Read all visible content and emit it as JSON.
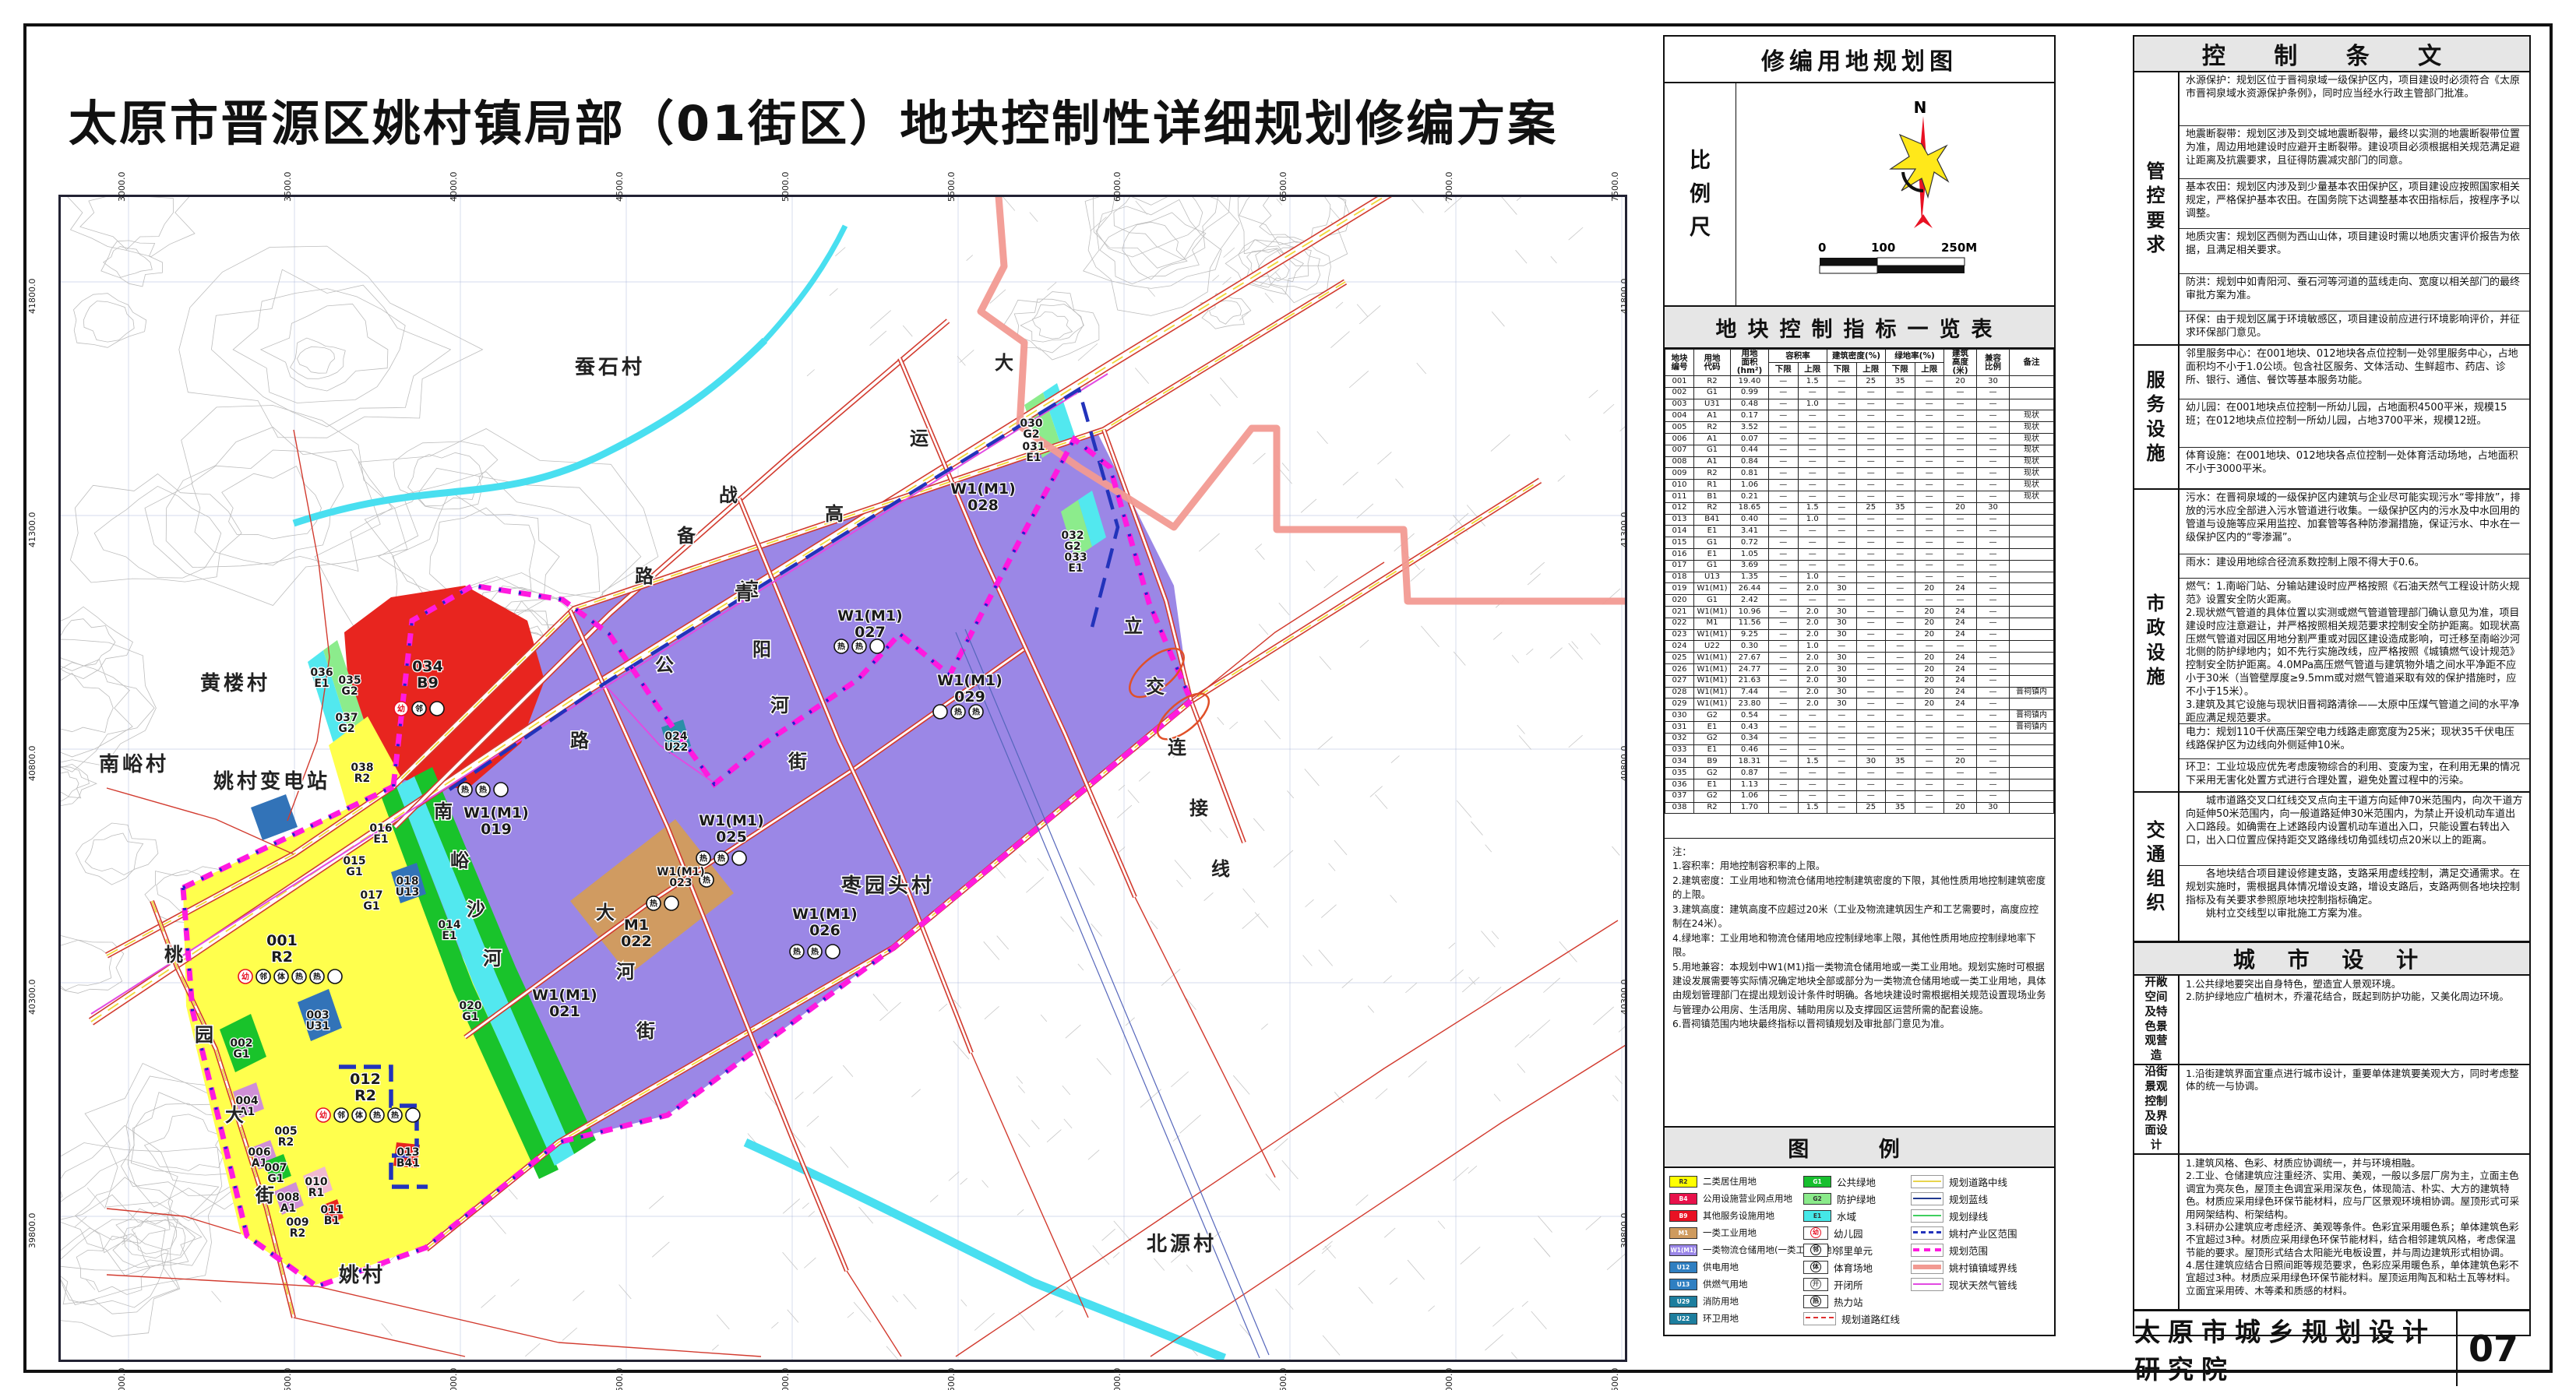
{
  "title": "太原市晋源区姚村镇局部（01街区）地块控制性详细规划修编方案",
  "footer": {
    "institute": "太原市城乡规划设计研究院",
    "page": "07"
  },
  "map": {
    "top_ticks": [
      "3000.0",
      "3500.0",
      "4000.0",
      "4500.0",
      "5000.0",
      "5500.0",
      "6000.0",
      "6500.0",
      "7000.0",
      "7500.0"
    ],
    "bottom_ticks": [
      "3000.0",
      "3500.0",
      "4000.0",
      "4500.0",
      "5000.0",
      "5500.0",
      "6000.0",
      "6500.0",
      "7000.0",
      "7500.0"
    ],
    "left_ticks": [
      "41800.0",
      "41300.0",
      "40800.0",
      "40300.0",
      "39800.0"
    ],
    "right_ticks": [
      "41800.0",
      "41300.0",
      "40800.0",
      "40300.0",
      "39800.0"
    ],
    "villages": [
      "黄楼村",
      "蚕石村",
      "南峪村",
      "姚村",
      "枣园头村",
      "北源村",
      "姚村变电站"
    ],
    "road_labels": [
      "大运高速公路",
      "战备路",
      "桃园大街",
      "大河街",
      "青阳河街",
      "立交连接线",
      "南峪沙河"
    ],
    "zones": [
      {
        "id": "001",
        "code": "R2"
      },
      {
        "id": "002",
        "code": "G1"
      },
      {
        "id": "003",
        "code": "U31"
      },
      {
        "id": "004",
        "code": "A1"
      },
      {
        "id": "005",
        "code": "R2"
      },
      {
        "id": "006",
        "code": "A1"
      },
      {
        "id": "007",
        "code": "G1"
      },
      {
        "id": "008",
        "code": "A1"
      },
      {
        "id": "009",
        "code": "R2"
      },
      {
        "id": "010",
        "code": "R1"
      },
      {
        "id": "011",
        "code": "B1"
      },
      {
        "id": "012",
        "code": "R2"
      },
      {
        "id": "013",
        "code": "B41"
      },
      {
        "id": "014",
        "code": "E1"
      },
      {
        "id": "015",
        "code": "G1"
      },
      {
        "id": "016",
        "code": "E1"
      },
      {
        "id": "017",
        "code": "G1"
      },
      {
        "id": "018",
        "code": "U13"
      },
      {
        "id": "019",
        "code": "W1(M1)"
      },
      {
        "id": "020",
        "code": "G1"
      },
      {
        "id": "021",
        "code": "W1(M1)"
      },
      {
        "id": "022",
        "code": "M1"
      },
      {
        "id": "023",
        "code": "W1(M1)"
      },
      {
        "id": "024",
        "code": "U22"
      },
      {
        "id": "025",
        "code": "W1(M1)"
      },
      {
        "id": "026",
        "code": "W1(M1)"
      },
      {
        "id": "027",
        "code": "W1(M1)"
      },
      {
        "id": "028",
        "code": "W1(M1)"
      },
      {
        "id": "029",
        "code": "W1(M1)"
      },
      {
        "id": "030",
        "code": "G2"
      },
      {
        "id": "031",
        "code": "E1"
      },
      {
        "id": "032",
        "code": "G2"
      },
      {
        "id": "033",
        "code": "E1"
      },
      {
        "id": "034",
        "code": "B9"
      },
      {
        "id": "035",
        "code": "G2"
      },
      {
        "id": "036",
        "code": "E1"
      },
      {
        "id": "037",
        "code": "G2"
      },
      {
        "id": "038",
        "code": "R2"
      }
    ]
  },
  "midpanel": {
    "map_title": "修编用地规划图",
    "scale_label": "比例尺",
    "north_label": "N",
    "scalebar_labels": [
      "0",
      "100",
      "250M"
    ],
    "table_title": "地块控制指标一览表",
    "table": {
      "headers": [
        "地块\n编号",
        "用地\n代码",
        "用地\n面积\n(hm²)",
        "容积率",
        "建筑密度(%)",
        "绿地率(%)",
        "建筑\n高度\n(米)",
        "兼容\n比例",
        "备注"
      ],
      "subheaders": [
        "下限",
        "上限"
      ],
      "rows": [
        [
          "001",
          "R2",
          "19.40",
          "—",
          "1.5",
          "—",
          "25",
          "35",
          "—",
          "20",
          "30",
          ""
        ],
        [
          "002",
          "G1",
          "0.99",
          "—",
          "—",
          "—",
          "—",
          "—",
          "—",
          "—",
          "—",
          ""
        ],
        [
          "003",
          "U31",
          "0.48",
          "—",
          "1.0",
          "—",
          "—",
          "—",
          "—",
          "—",
          "—",
          ""
        ],
        [
          "004",
          "A1",
          "0.17",
          "—",
          "—",
          "—",
          "—",
          "—",
          "—",
          "—",
          "—",
          "现状"
        ],
        [
          "005",
          "R2",
          "3.52",
          "—",
          "—",
          "—",
          "—",
          "—",
          "—",
          "—",
          "—",
          "现状"
        ],
        [
          "006",
          "A1",
          "0.07",
          "—",
          "—",
          "—",
          "—",
          "—",
          "—",
          "—",
          "—",
          "现状"
        ],
        [
          "007",
          "G1",
          "0.44",
          "—",
          "—",
          "—",
          "—",
          "—",
          "—",
          "—",
          "—",
          "现状"
        ],
        [
          "008",
          "A1",
          "0.84",
          "—",
          "—",
          "—",
          "—",
          "—",
          "—",
          "—",
          "—",
          "现状"
        ],
        [
          "009",
          "R2",
          "0.81",
          "—",
          "—",
          "—",
          "—",
          "—",
          "—",
          "—",
          "—",
          "现状"
        ],
        [
          "010",
          "R1",
          "1.06",
          "—",
          "—",
          "—",
          "—",
          "—",
          "—",
          "—",
          "—",
          "现状"
        ],
        [
          "011",
          "B1",
          "0.21",
          "—",
          "—",
          "—",
          "—",
          "—",
          "—",
          "—",
          "—",
          "现状"
        ],
        [
          "012",
          "R2",
          "18.65",
          "—",
          "1.5",
          "—",
          "25",
          "35",
          "—",
          "20",
          "30",
          ""
        ],
        [
          "013",
          "B41",
          "0.40",
          "—",
          "1.0",
          "—",
          "—",
          "—",
          "—",
          "—",
          "—",
          ""
        ],
        [
          "014",
          "E1",
          "3.41",
          "—",
          "—",
          "—",
          "—",
          "—",
          "—",
          "—",
          "—",
          ""
        ],
        [
          "015",
          "G1",
          "0.72",
          "—",
          "—",
          "—",
          "—",
          "—",
          "—",
          "—",
          "—",
          ""
        ],
        [
          "016",
          "E1",
          "1.05",
          "—",
          "—",
          "—",
          "—",
          "—",
          "—",
          "—",
          "—",
          ""
        ],
        [
          "017",
          "G1",
          "3.69",
          "—",
          "—",
          "—",
          "—",
          "—",
          "—",
          "—",
          "—",
          ""
        ],
        [
          "018",
          "U13",
          "1.35",
          "—",
          "1.0",
          "—",
          "—",
          "—",
          "—",
          "—",
          "—",
          ""
        ],
        [
          "019",
          "W1(M1)",
          "26.44",
          "—",
          "2.0",
          "30",
          "—",
          "—",
          "20",
          "24",
          "—",
          ""
        ],
        [
          "020",
          "G1",
          "2.42",
          "—",
          "—",
          "—",
          "—",
          "—",
          "—",
          "—",
          "—",
          ""
        ],
        [
          "021",
          "W1(M1)",
          "10.96",
          "—",
          "2.0",
          "30",
          "—",
          "—",
          "20",
          "24",
          "—",
          ""
        ],
        [
          "022",
          "M1",
          "11.56",
          "—",
          "2.0",
          "30",
          "—",
          "—",
          "20",
          "24",
          "—",
          ""
        ],
        [
          "023",
          "W1(M1)",
          "9.25",
          "—",
          "2.0",
          "30",
          "—",
          "—",
          "20",
          "24",
          "—",
          ""
        ],
        [
          "024",
          "U22",
          "0.30",
          "—",
          "1.0",
          "—",
          "—",
          "—",
          "—",
          "—",
          "—",
          ""
        ],
        [
          "025",
          "W1(M1)",
          "27.67",
          "—",
          "2.0",
          "30",
          "—",
          "—",
          "20",
          "24",
          "—",
          ""
        ],
        [
          "026",
          "W1(M1)",
          "24.77",
          "—",
          "2.0",
          "30",
          "—",
          "—",
          "20",
          "24",
          "—",
          ""
        ],
        [
          "027",
          "W1(M1)",
          "21.63",
          "—",
          "2.0",
          "30",
          "—",
          "—",
          "20",
          "24",
          "—",
          ""
        ],
        [
          "028",
          "W1(M1)",
          "7.44",
          "—",
          "2.0",
          "30",
          "—",
          "—",
          "20",
          "24",
          "—",
          "晋祠镇内"
        ],
        [
          "029",
          "W1(M1)",
          "23.80",
          "—",
          "2.0",
          "30",
          "—",
          "—",
          "20",
          "24",
          "—",
          ""
        ],
        [
          "030",
          "G2",
          "0.54",
          "—",
          "—",
          "—",
          "—",
          "—",
          "—",
          "—",
          "—",
          "晋祠镇内"
        ],
        [
          "031",
          "E1",
          "0.43",
          "—",
          "—",
          "—",
          "—",
          "—",
          "—",
          "—",
          "—",
          "晋祠镇内"
        ],
        [
          "032",
          "G2",
          "0.34",
          "—",
          "—",
          "—",
          "—",
          "—",
          "—",
          "—",
          "—",
          ""
        ],
        [
          "033",
          "E1",
          "0.46",
          "—",
          "—",
          "—",
          "—",
          "—",
          "—",
          "—",
          "—",
          ""
        ],
        [
          "034",
          "B9",
          "18.31",
          "—",
          "1.5",
          "—",
          "30",
          "35",
          "—",
          "20",
          "—",
          ""
        ],
        [
          "035",
          "G2",
          "0.87",
          "—",
          "—",
          "—",
          "—",
          "—",
          "—",
          "—",
          "—",
          ""
        ],
        [
          "036",
          "E1",
          "1.13",
          "—",
          "—",
          "—",
          "—",
          "—",
          "—",
          "—",
          "—",
          ""
        ],
        [
          "037",
          "G2",
          "1.06",
          "—",
          "—",
          "—",
          "—",
          "—",
          "—",
          "—",
          "—",
          ""
        ],
        [
          "038",
          "R2",
          "1.70",
          "—",
          "1.5",
          "—",
          "25",
          "35",
          "—",
          "20",
          "30",
          ""
        ]
      ],
      "notes": "注：\n1.容积率：用地控制容积率的上限。\n2.建筑密度：工业用地和物流仓储用地控制建筑密度的下限，其他性质用地控制建筑密度的上限。\n3.建筑高度：建筑高度不应超过20米（工业及物流建筑因生产和工艺需要时，高度应控制在24米）。\n4.绿地率：工业用地和物流仓储用地应控制绿地率上限，其他性质用地应控制绿地率下限。\n5.用地兼容：本规划中W1(M1)指一类物流仓储用地或一类工业用地。规划实施时可根据建设发展需要等实际情况确定地块全部或部分为一类物流仓储用地或一类工业用地，具体由规划管理部门在提出规划设计条件时明确。各地块建设时需根据相关规范设置现场业务与管理办公用房、生活用房、辅助用房以及支撑园区运营所需的配套设施。\n6.晋祠镇范围内地块最终指标以晋祠镇规划及审批部门意见为准。"
    },
    "legend_title": "图  例",
    "legend": {
      "col1": [
        {
          "code": "R2",
          "color": "#ffff00",
          "tc": "#333",
          "label": "二类居住用地"
        },
        {
          "code": "B4",
          "color": "#e8114b",
          "tc": "#fff",
          "label": "公用设施营业网点用地"
        },
        {
          "code": "B9",
          "color": "#e81123",
          "tc": "#fff",
          "label": "其他服务设施用地"
        },
        {
          "code": "M1",
          "color": "#cf9b5e",
          "tc": "#fff",
          "label": "一类工业用地"
        },
        {
          "code": "W1(M1)",
          "color": "#9a86e8",
          "tc": "#fff",
          "label": "一类物流仓储用地(一类工业用地)"
        },
        {
          "code": "U12",
          "color": "#2f7fc1",
          "tc": "#fff",
          "label": "供电用地"
        },
        {
          "code": "U13",
          "color": "#2f7fc1",
          "tc": "#fff",
          "label": "供燃气用地"
        },
        {
          "code": "U29",
          "color": "#1d7e9e",
          "tc": "#fff",
          "label": "消防用地"
        },
        {
          "code": "U22",
          "color": "#1d7e9e",
          "tc": "#fff",
          "label": "环卫用地"
        }
      ],
      "col2": [
        {
          "code": "G1",
          "color": "#17bf2e",
          "tc": "#fff",
          "label": "公共绿地"
        },
        {
          "code": "G2",
          "color": "#8aea8a",
          "tc": "#333",
          "label": "防护绿地"
        },
        {
          "code": "E1",
          "color": "#45e8e8",
          "tc": "#333",
          "label": "水域"
        },
        {
          "icon": "幼",
          "ic": "#e81123",
          "label": "幼儿园"
        },
        {
          "icon": "邻",
          "ic": "#111",
          "label": "邻里单元"
        },
        {
          "icon": "体",
          "ic": "#111",
          "label": "体育场地"
        },
        {
          "icon": "开",
          "ic": "#555",
          "label": "开闭所"
        },
        {
          "icon": "热",
          "ic": "#111",
          "label": "热力站"
        },
        {
          "line": "redline",
          "label": "规划道路红线"
        }
      ],
      "col3": [
        {
          "line": "centerline",
          "label": "规划道路中线"
        },
        {
          "line": "blueline",
          "label": "规划蓝线"
        },
        {
          "line": "greenline",
          "label": "规划绿线"
        },
        {
          "line": "industry",
          "label": "姚村产业区范围"
        },
        {
          "line": "scope",
          "label": "规划范围"
        },
        {
          "line": "townline",
          "label": "姚村镇镇域界线"
        },
        {
          "line": "gasline",
          "label": "现状天然气管线"
        }
      ]
    }
  },
  "provisions": {
    "title": "控  制  条  文",
    "sections": [
      {
        "label": "管控要求",
        "items": [
          "水源保护：规划区位于晋祠泉域一级保护区内，项目建设时必须符合《太原市晋祠泉域水资源保护条例》，同时应当经水行政主管部门批准。",
          "地震断裂带：规划区涉及到交城地震断裂带，最终以实测的地震断裂带位置为准，周边用地建设时应避开主断裂带。建设项目必须根据相关规范满足避让距离及抗震要求，且征得防震减灾部门的同意。",
          "基本农田：规划区内涉及到少量基本农田保护区，项目建设应按照国家相关规定，严格保护基本农田。在国务院下达调整基本农田指标后，按程序予以调整。",
          "地质灾害：规划区西侧为西山山体，项目建设时需以地质灾害评价报告为依据，且满足相关要求。",
          "防洪：规划中如青阳河、蚕石河等河道的蓝线走向、宽度以相关部门的最终审批方案为准。",
          "环保：由于规划区属于环境敏感区，项目建设前应进行环境影响评价，并征求环保部门意见。"
        ]
      },
      {
        "label": "服务设施",
        "items": [
          "邻里服务中心：在001地块、012地块各点位控制一处邻里服务中心，占地面积均不小于1.0公顷。包含社区服务、文体活动、生鲜超市、药店、诊所、银行、通信、餐饮等基本服务功能。",
          "幼儿园：在001地块点位控制一所幼儿园，占地面积4500平米，规模15班；在012地块点位控制一所幼儿园，占地3700平米，规模12班。",
          "体育设施：在001地块、012地块各点位控制一处体育活动场地，占地面积不小于3000平米。"
        ]
      },
      {
        "label": "市政设施",
        "items": [
          "污水：在晋祠泉域的一级保护区内建筑与企业尽可能实现污水“零排放”，排放的污水应全部进入污水管道进行收集。一级保护区内的污水及中水回用的管道与设施等应采用监控、加套管等各种防渗漏措施，保证污水、中水在一级保护区内的“零渗漏”。",
          "雨水：建设用地综合径流系数控制上限不得大于0.6。",
          "燃气：1.南峪门站、分输站建设时应严格按照《石油天然气工程设计防火规范》设置安全防火距离。\n2.现状燃气管道的具体位置以实测或燃气管道管理部门确认意见为准，项目建设时应注意避让，并严格按照相关规范要求控制安全防护距离。如现状高压燃气管道对园区用地分割严重或对园区建设造成影响，可迁移至南峪沙河北侧的防护绿地内；如不先行实施改线，应严格按照《城镇燃气设计规范》控制安全防护距离。4.0MPa高压燃气管道与建筑物外墙之间水平净距不应小于30米（当管壁厚度≥9.5mm或对燃气管道采取有效的保护措施时，应不小于15米）。\n3.建筑及其它设施与现状旧晋祠路清徐——太原中压煤气管道之间的水平净距应满足规范要求。",
          "电力：规划110千伏高压架空电力线路走廊宽度为25米；现状35千伏电压线路保护区为边线向外侧延伸10米。",
          "环卫：工业垃圾应优先考虑废物综合的利用、变废为宝，在利用无果的情况下采用无害化处置方式进行合理处置，避免处置过程中的污染。"
        ]
      },
      {
        "label": "交通组织",
        "items": [
          "　　城市道路交叉口红线交叉点向主干道方向延伸70米范围内，向次干道方向延伸50米范围内，向一般道路延伸30米范围内，为禁止开设机动车道出入口路段。如确需在上述路段内设置机动车道出入口，只能设置右转出入口，出入口位置应保持距交叉路缘线切角弧线切点20米以上的距离。",
          "　　各地块结合项目建设修建支路，支路采用虚线控制，满足交通需求。在规划实施时，需根据具体情况增设支路，增设支路后，支路两侧各地块控制指标及有关要求参照原地块控制指标确定。\n　　姚村立交线型以审批施工方案为准。"
        ]
      }
    ]
  },
  "urban_design": {
    "title": "城 市 设 计",
    "sections": [
      {
        "label": "开敞空间及特色景观营造",
        "items": [
          "1.公共绿地要突出自身特色，塑造宜人景观环境。\n2.防护绿地应广植树木，乔灌花结合，既起到防护功能，又美化周边环境。"
        ]
      },
      {
        "label": "沿街景观控制及界面设计",
        "items": [
          "1.沿街建筑界面宜重点进行城市设计，重要单体建筑要美观大方，同时考虑整体的统一与协调。"
        ]
      },
      {
        "label": "",
        "items": [
          "1.建筑风格、色彩、材质应协调统一，并与环境相融。\n2.工业、仓储建筑应注重经济、实用、美观，一般以多层厂房为主，立面主色调宜为亮灰色，屋顶主色调宜采用深灰色，体现简洁、朴实、大方的建筑特色。材质应采用绿色环保节能材料，应与厂区景观环境相协调。屋顶形式可采用网架结构、桁架结构。\n3.科研办公建筑应考虑经济、美观等条件。色彩宜采用暖色系；单体建筑色彩不宜超过3种。材质应采用绿色环保节能材料，结合相邻建筑风格，考虑保温节能的要求。屋顶形式结合太阳能光电板设置，并与周边建筑形式相协调。\n4.居住建筑应结合日照间距等规范要求，色彩应采用暖色系，单体建筑色彩不宜超过3种。材质应采用绿色环保节能材料。屋顶运用陶瓦和粘土瓦等材料。立面宜采用砖、木等柔和质感的材料。"
        ]
      }
    ]
  }
}
